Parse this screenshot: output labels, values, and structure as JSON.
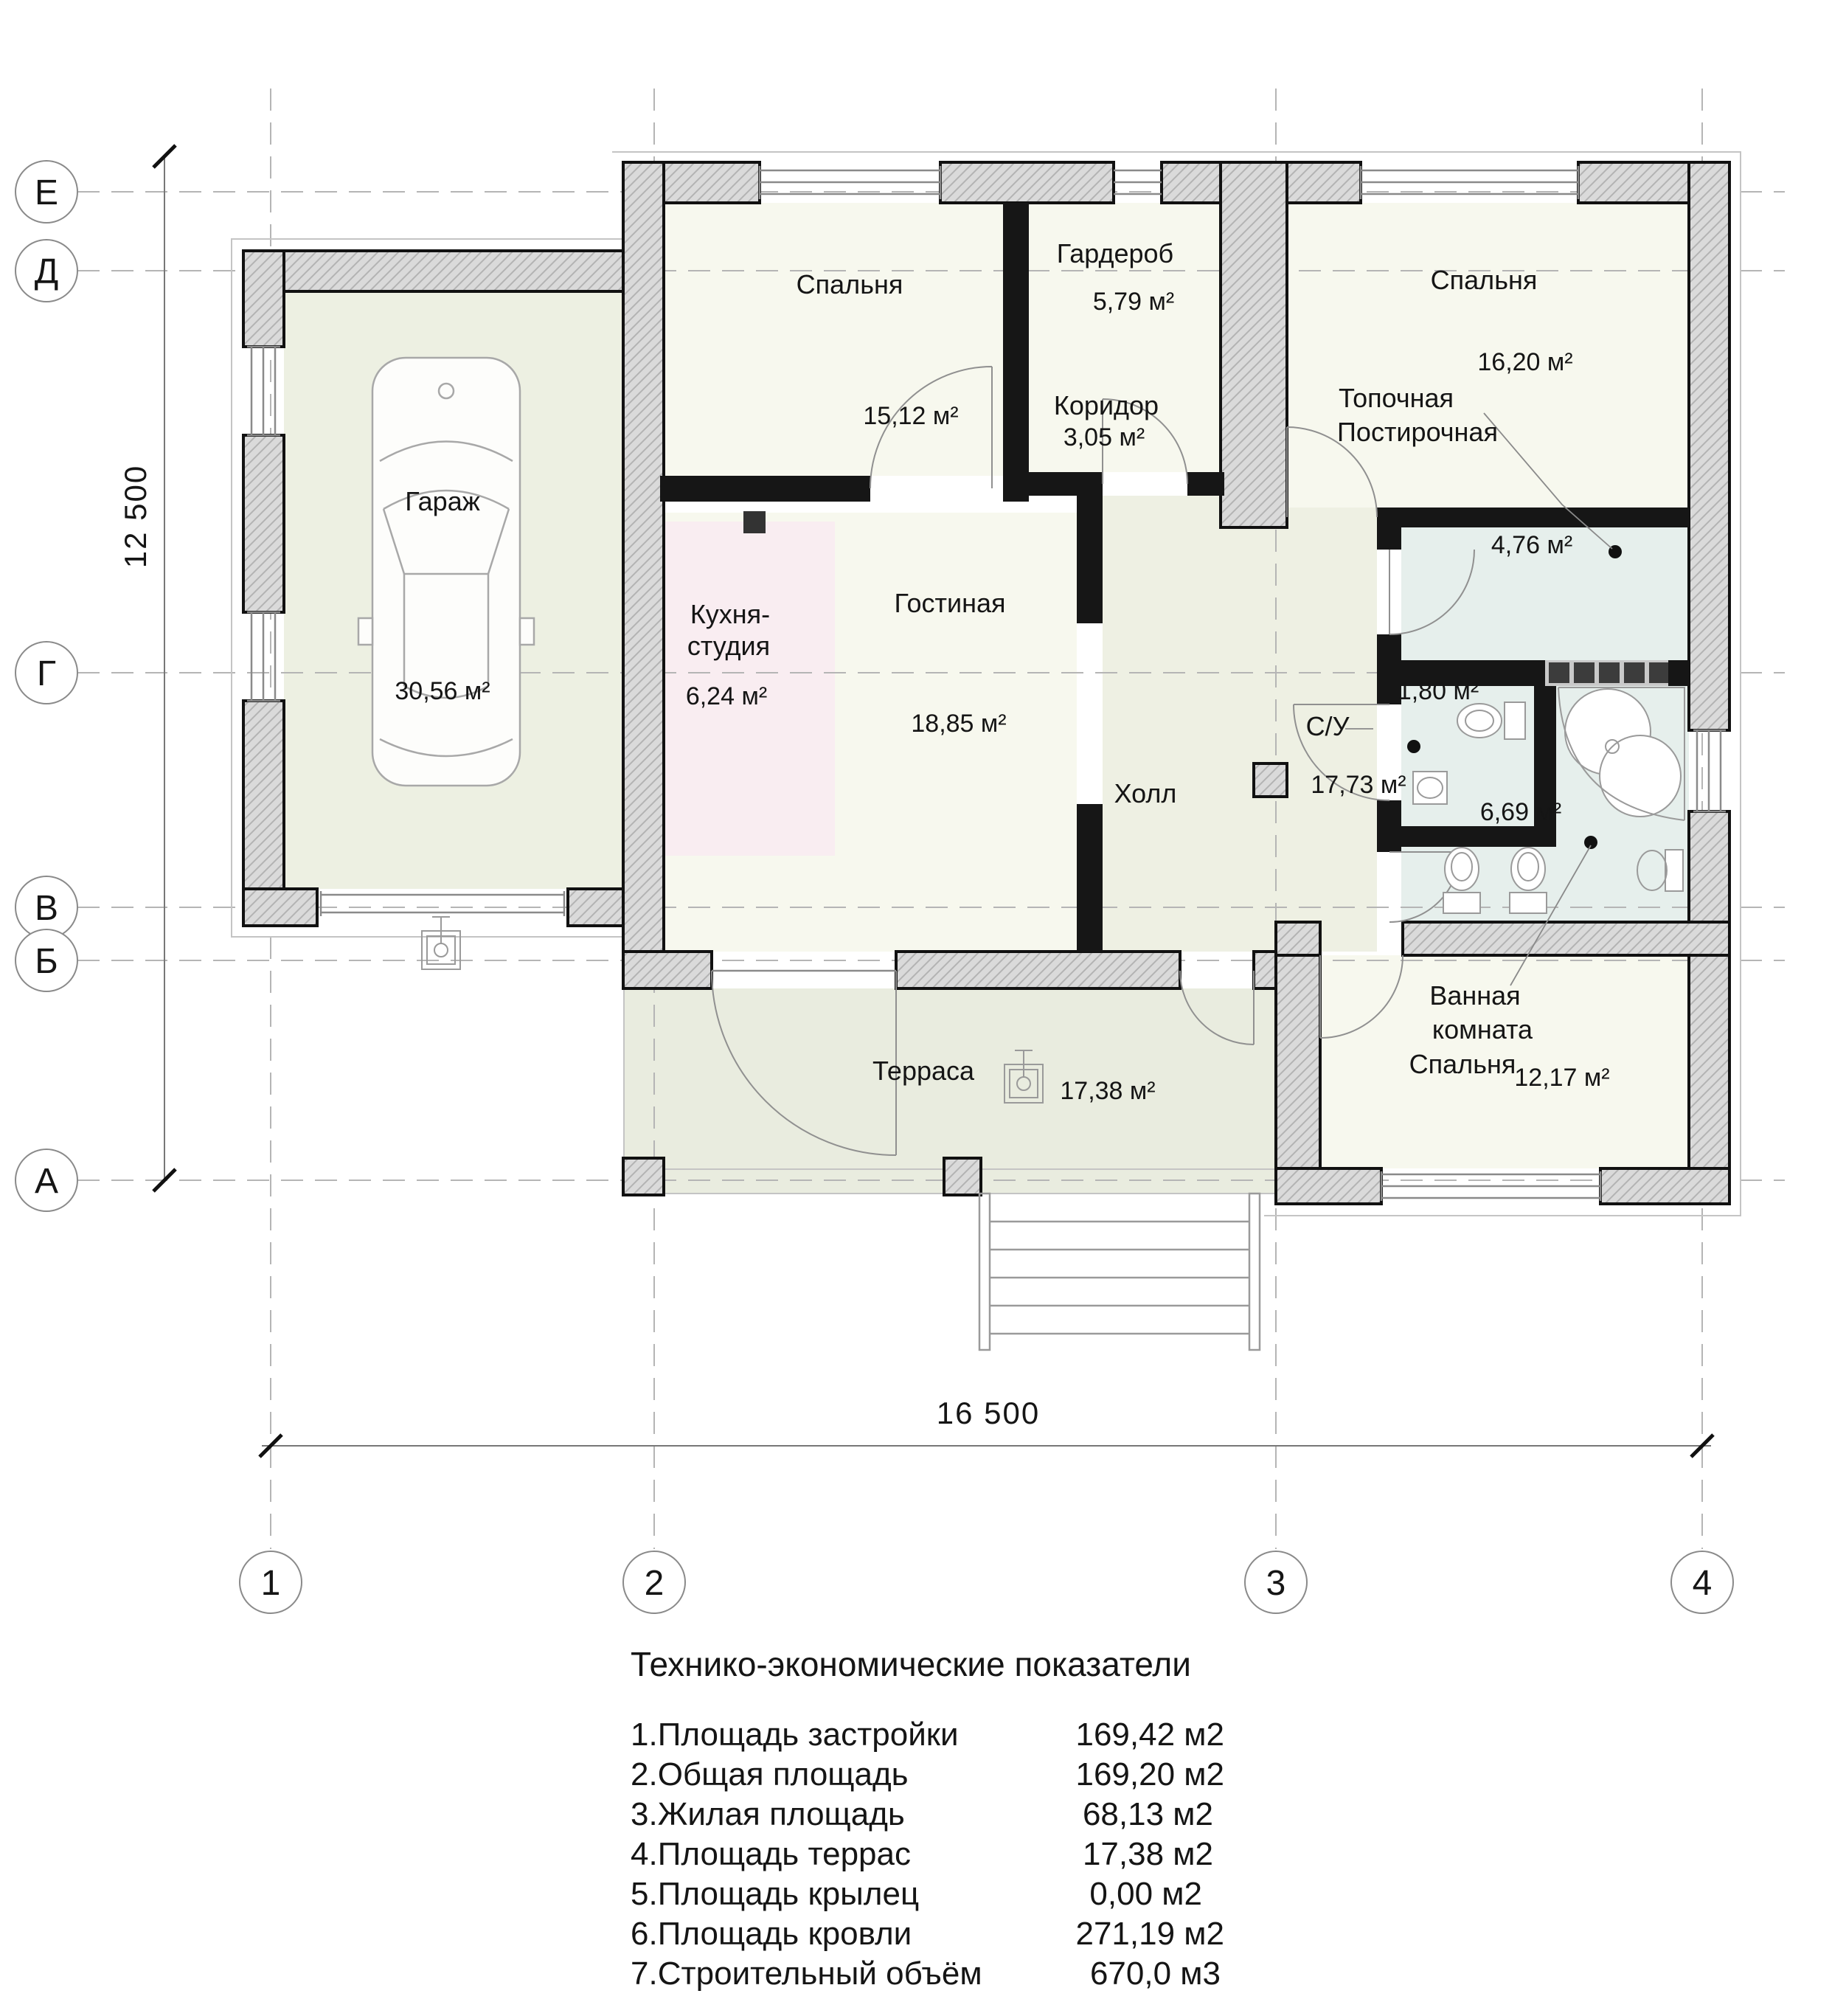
{
  "plan": {
    "dimensions": {
      "horizontal": "16 500",
      "vertical": "12 500"
    },
    "grid": {
      "row_labels": [
        "Е",
        "Д",
        "Г",
        "В",
        "Б",
        "А"
      ],
      "col_labels": [
        "1",
        "2",
        "3",
        "4"
      ]
    },
    "rooms": {
      "garage": {
        "name": "Гараж",
        "area": "30,56 м²"
      },
      "bedroom_left": {
        "name": "Спальня",
        "area": "15,12 м²"
      },
      "wardrobe": {
        "name": "Гардероб",
        "area": "5,79 м²"
      },
      "corridor": {
        "name": "Коридор",
        "area": "3,05 м²"
      },
      "bedroom_right": {
        "name": "Спальня",
        "area": "16,20 м²"
      },
      "boiler_laundry": {
        "name_line1": "Топочная",
        "name_line2": "Постирочная",
        "area": "4,76 м²"
      },
      "kitchen_studio": {
        "name_line1": "Кухня-",
        "name_line2": "студия",
        "area": "6,24 м²"
      },
      "living_room": {
        "name": "Гостиная",
        "area": "18,85 м²"
      },
      "hall": {
        "name": "Холл",
        "area": "17,73 м²"
      },
      "wc": {
        "name": "С/У",
        "area": "1,80 м²"
      },
      "bathroom": {
        "area": "6,69 м²"
      },
      "bath_bedroom": {
        "name_line1": "Ванная",
        "name_line2": "комната",
        "name_line3": "Спальня",
        "area": "12,17 м²"
      },
      "terrace": {
        "name": "Терраса",
        "area": "17,38 м²"
      }
    },
    "indicators": {
      "title": "Технико-экономические показатели",
      "rows": [
        {
          "label": "1.Площадь застройки",
          "value": "169,42 м2"
        },
        {
          "label": "2.Общая площадь",
          "value": "169,20 м2"
        },
        {
          "label": "3.Жилая площадь",
          "value": "68,13 м2"
        },
        {
          "label": "4.Площадь террас",
          "value": "17,38 м2"
        },
        {
          "label": "5.Площадь крылец",
          "value": "0,00 м2"
        },
        {
          "label": "6.Площадь кровли",
          "value": "271,19 м2"
        },
        {
          "label": "7.Строительный объём",
          "value": "670,0 м3"
        }
      ]
    }
  }
}
